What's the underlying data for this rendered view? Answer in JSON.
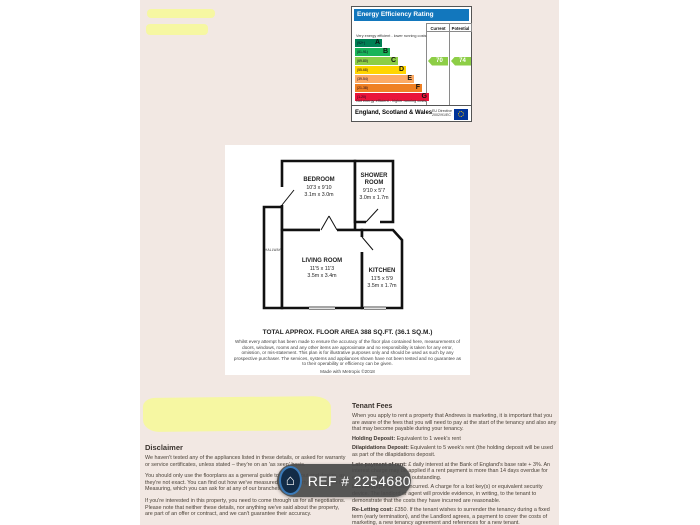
{
  "page": {
    "paper_color": "#f2e8e3",
    "highlight_color": "#f6f89e"
  },
  "epc": {
    "title": "Energy Efficiency Rating",
    "columns": {
      "current": "Current",
      "potential": "Potential"
    },
    "top_note": "Very energy efficient - lower running costs",
    "bottom_note": "Not energy efficient - higher running costs",
    "footer_region": "England, Scotland & Wales",
    "footer_directive_line1": "EU Directive",
    "footer_directive_line2": "2002/91/EC",
    "bands": [
      {
        "letter": "A",
        "range": "(92+)",
        "color": "#008054"
      },
      {
        "letter": "B",
        "range": "(81-91)",
        "color": "#19b459"
      },
      {
        "letter": "C",
        "range": "(69-80)",
        "color": "#8dce46"
      },
      {
        "letter": "D",
        "range": "(55-68)",
        "color": "#ffd500"
      },
      {
        "letter": "E",
        "range": "(39-54)",
        "color": "#fcaa65"
      },
      {
        "letter": "F",
        "range": "(21-38)",
        "color": "#ef8023"
      },
      {
        "letter": "G",
        "range": "(1-20)",
        "color": "#e9153b"
      }
    ],
    "current": {
      "value": "70",
      "band": "C",
      "color": "#8dce46"
    },
    "potential": {
      "value": "74",
      "band": "C",
      "color": "#8dce46"
    }
  },
  "floorplan": {
    "rooms": {
      "bedroom": {
        "name": "BEDROOM",
        "imperial": "10'3 x 9'10",
        "metric": "3.1m x 3.0m"
      },
      "shower": {
        "name_line1": "SHOWER",
        "name_line2": "ROOM",
        "imperial": "9'10 x 5'7",
        "metric": "3.0m x 1.7m"
      },
      "living": {
        "name": "LIVING ROOM",
        "imperial": "11'5 x 11'3",
        "metric": "3.5m x 3.4m"
      },
      "kitchen": {
        "name": "KITCHEN",
        "imperial": "11'5 x 5'9",
        "metric": "3.5m x 1.7m"
      }
    },
    "hallway_label": "HALLWAY",
    "total_area": "TOTAL APPROX. FLOOR AREA 388 SQ.FT. (36.1 SQ.M.)",
    "fine_print": "Whilst every attempt has been made to ensure the accuracy of the floor plan contained here, measurements of doors, windows, rooms and any other items are approximate and no responsibility is taken for any error, omission, or mis-statement. This plan is for illustrative purposes only and should be used as such by any prospective purchaser. The services, systems and appliances shown have not been tested and no guarantee as to their operability or efficiency can be given.",
    "credit": "Made with Metropix ©2018"
  },
  "disclaimer": {
    "heading": "Disclaimer",
    "paragraphs": [
      "We haven't tested any of the appliances listed in these details, or asked for warranty or service certificates, unless stated – they're on an 'as seen' basis.",
      "You should only use the floorplans as a general guide to room layout and design, as they're not exact. You can find out how we've measured the property in our guide to Measuring, which you can ask for at any of our branches/",
      "If you're interested in this property, you need to come through us for all negotiations. Please note that neither these details, nor anything we've said about the property, are part of an offer or contract, and we can't guarantee their accuracy."
    ]
  },
  "tenant_fees": {
    "heading": "Tenant Fees",
    "intro": "When you apply to rent a property that Andrews is marketing, it is important that you are aware of the fees that you will need to pay at the start of the tenancy and also any that may become payable during your tenancy.",
    "items": [
      {
        "label": "Holding Deposit:",
        "text": " Equivalent to 1 week's rent"
      },
      {
        "label": "Dilapidations Deposit:",
        "text": " Equivalent to 5 week's rent (the holding deposit will be used as part of the dilapidations deposit."
      },
      {
        "label": "Late payment of rent:",
        "text": " £ daily interest at the Bank of England's base rate + 3%. An interest charge may be applied if a rent payment is more than 14 days overdue for each day the payment is outstanding."
      },
      {
        "label": "Lost key(s):",
        "text": " Any costs incurred. A charge for a lost key(s) or equivalent security device. The landlord or agent will provide evidence, in writing, to the tenant to demonstrate that the costs they have incurred are reasonable."
      },
      {
        "label": "Re-Letting cost:",
        "text": " £350. If the tenant wishes to surrender the tenancy during a fixed term (early termination), and the Landlord agrees, a payment to cover the costs of marketing, a new tenancy agreement and references for a new tenant."
      }
    ]
  },
  "ref_badge": {
    "label": "REF # 2254680",
    "icon_glyph": "⌂"
  }
}
